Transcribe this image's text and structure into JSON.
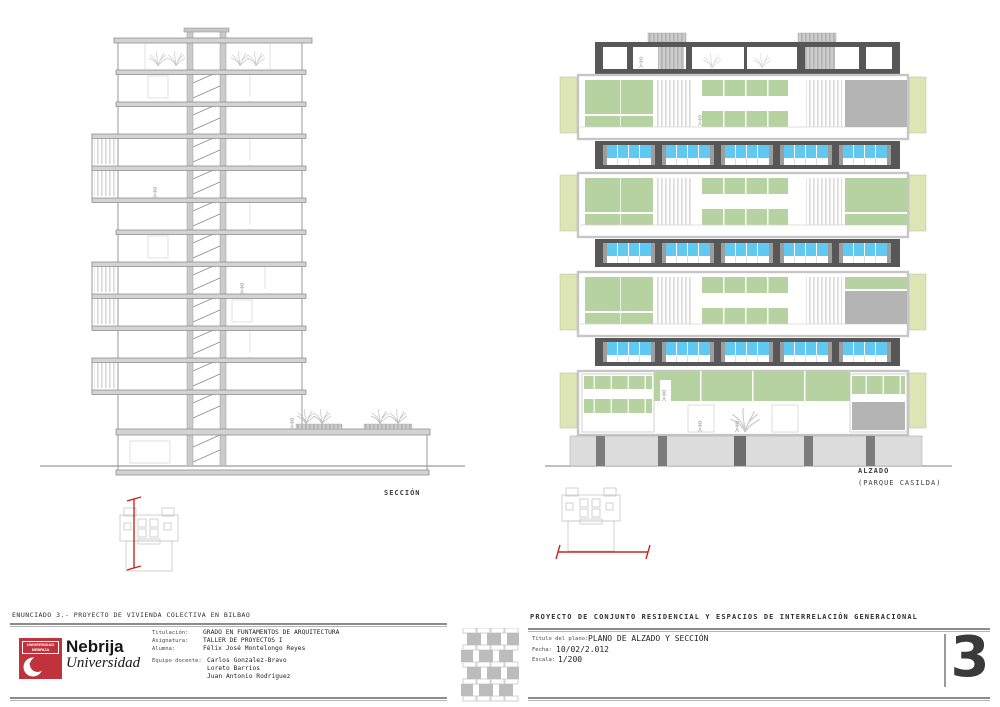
{
  "colors": {
    "accent_red": "#c0323c",
    "section_red": "#c8281e",
    "dark_frame": "#575757",
    "window_blue": "#5fc9f1",
    "panel_green": "#b6d2a1",
    "fin_pale": "#dee5b5",
    "panel_gray": "#b4b4b4",
    "podium_gray": "#dcdcdc",
    "pillar_gray": "#7c7c7c"
  },
  "section": {
    "label": "SECCIÓN"
  },
  "elevation": {
    "label": "ALZADO",
    "sublabel": "(PARQUE CASILDA)"
  },
  "footer": {
    "enunciado": "ENUNCIADO 3.-  PROYECTO DE VIVIENDA COLECTIVA EN BILBAO",
    "project_title": "PROYECTO DE CONJUNTO RESIDENCIAL Y ESPACIOS DE INTERRELACIÓN GENERACIONAL",
    "logo": {
      "tag_line1": "UNIVERSIDAD",
      "tag_line2": "NEBRIJA",
      "name": "Nebrija",
      "subname": "Universidad"
    },
    "fields": [
      {
        "label": "Titulación:",
        "value": "GRADO EN FUNTAMENTOS DE ARQUITECTURA"
      },
      {
        "label": "Asignatura:",
        "value": "TALLER DE PROYECTOS I"
      },
      {
        "label": "Alumna:",
        "value": "Félix José Montelongo Reyes"
      },
      {
        "label": "Equipo docente:",
        "value": "Carlos Gonzalez-Bravo"
      }
    ],
    "team": [
      "Carlos Gonzalez-Bravo",
      "Loreto Barrios",
      "Juan Antonio Rodríguez"
    ],
    "plan_title_label": "Título del plano:",
    "plan_title": "PLANO DE ALZADO Y SECCIÓN",
    "date_label": "Fecha:",
    "date": "10/02/2.012",
    "scale_label": "Escala:",
    "scale": "1/200",
    "sheet_number": "3"
  }
}
